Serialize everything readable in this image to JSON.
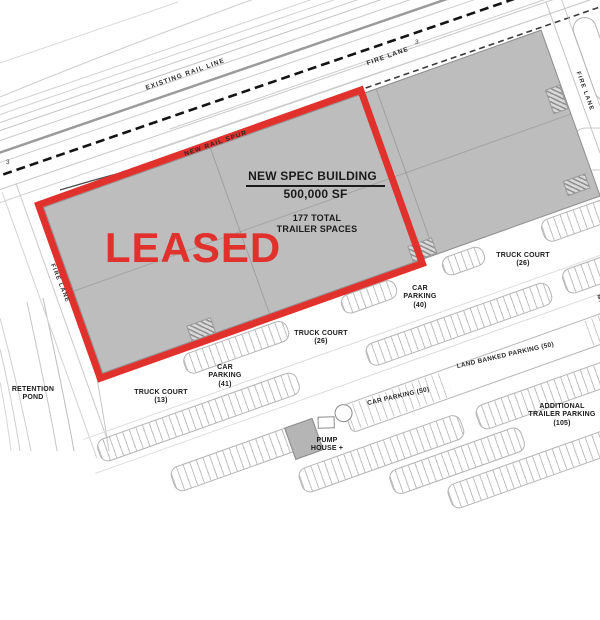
{
  "building": {
    "name": "NEW SPEC BUILDING",
    "size": "500,000 SF",
    "trailer_line1": "177 TOTAL",
    "trailer_line2": "TRAILER SPACES",
    "stamp": "LEASED"
  },
  "labels": {
    "existing_rail": "EXISTING RAIL LINE",
    "new_rail_spur": "NEW RAIL SPUR",
    "fire_lane_top": "FIRE LANE",
    "fire_lane_right": "FIRE LANE",
    "fire_lane_left": "FIRE LANE",
    "truck_court_right": "TRUCK COURT (26)",
    "car_parking_40": "CAR PARKING (40)",
    "truck_court_center": "TRUCK COURT (26)",
    "car_parking_41": "CAR PARKING (41)",
    "truck_court_13": "TRUCK COURT (13)",
    "retention_pond": "RETENTION POND",
    "land_banked": "LAND BANKED PARKING (50)",
    "car_parking_50": "CAR PARKING (50)",
    "additional_trailer": "ADDITIONAL TRAILER PARKING (105)",
    "pump_house": "PUMP HOUSE +",
    "edge_partial": "MAI"
  },
  "markers": {
    "m1": "3",
    "m2": "3"
  },
  "colors": {
    "leased_red": "#e0312d",
    "building_gray": "#bdbdbd"
  }
}
